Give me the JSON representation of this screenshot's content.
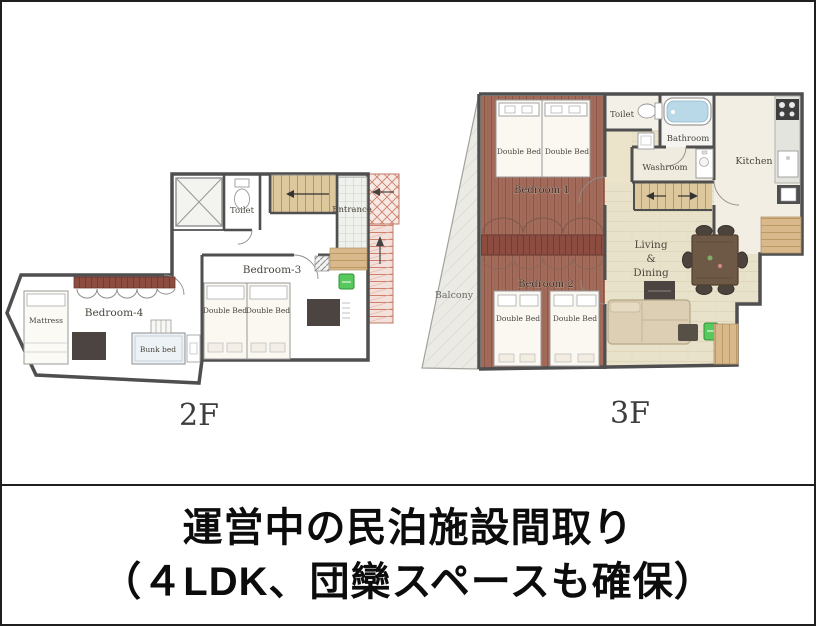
{
  "caption": {
    "line1": "運営中の民泊施設間取り",
    "line2": "（４LDK、団欒スペースも確保）"
  },
  "floor_2f": {
    "label": "2F",
    "rooms": {
      "toilet": "Toilet",
      "entrance": "Entrance",
      "bedroom3": "Bedroom-3",
      "bedroom4": "Bedroom-4"
    },
    "furniture": {
      "double_bed_a": "Double Bed",
      "double_bed_b": "Double Bed",
      "mattress": "Mattress",
      "bunk_bed": "Bunk bed"
    }
  },
  "floor_3f": {
    "label": "3F",
    "rooms": {
      "toilet": "Toilet",
      "bathroom": "Bathroom",
      "washroom": "Washroom",
      "kitchen": "Kitchen",
      "bedroom1": "Bedroom-1",
      "bedroom2": "Bedroom-2",
      "balcony": "Balcony",
      "living_dining": [
        "Living",
        "&",
        "Dining"
      ]
    },
    "furniture": {
      "bed1a": "Double Bed",
      "bed1b": "Double Bed",
      "bed2a": "Double Bed",
      "bed2b": "Double Bed"
    }
  },
  "colors": {
    "border": "#1f1f1f",
    "wall": "#4f4f4f",
    "floor_light_wood": "#e9e2cb",
    "floor_red_wood": "#a26b5a",
    "closet_maroon": "#8c4c40",
    "stair_wood": "#ddc89e",
    "external_stairs_red": "#cf7f6c",
    "accent_green": "#58c95c",
    "bathtub_blue": "#b9d8e8"
  }
}
